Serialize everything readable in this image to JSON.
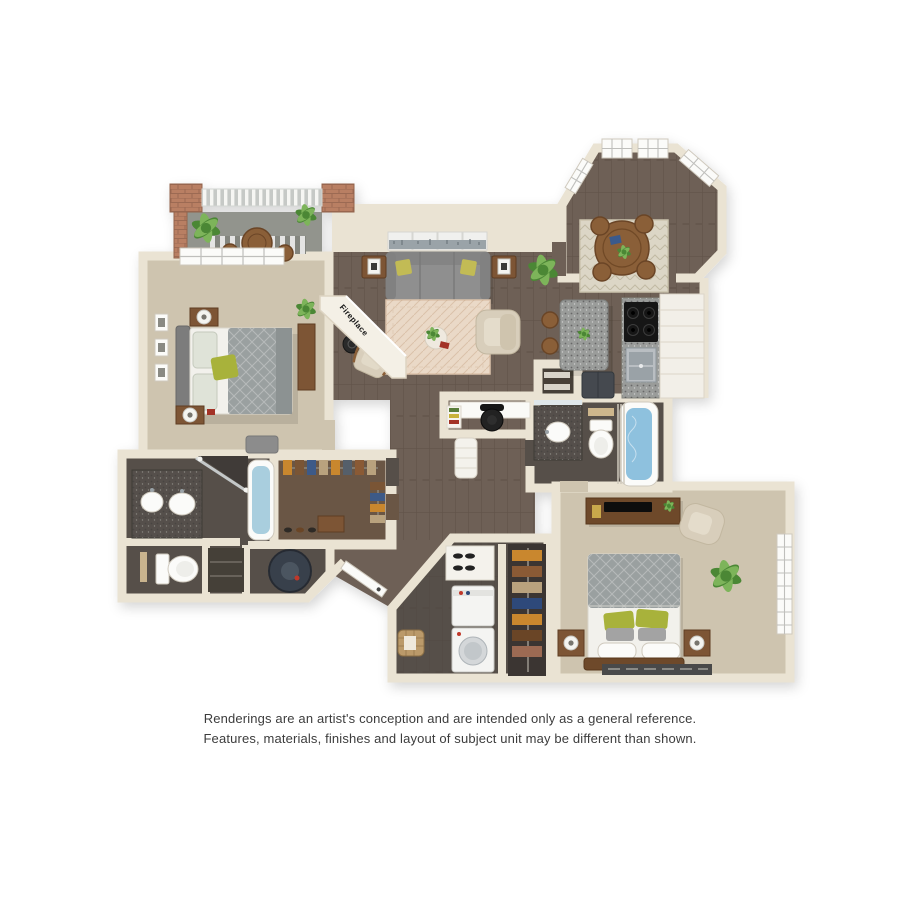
{
  "floorplan": {
    "fireplace_label": "Fireplace",
    "type": "3d-floor-plan-rendering",
    "rooms_depicted": [
      "balcony",
      "bedroom-1",
      "living-room",
      "dining-nook",
      "kitchen",
      "bathroom-2",
      "bedroom-2",
      "master-bathroom",
      "walk-in-closet",
      "laundry-room",
      "entry-hall",
      "desk-nook"
    ]
  },
  "disclaimer": {
    "line1": "Renderings are an artist's conception and are intended only as a general reference.",
    "line2": "Features, materials, finishes and layout of subject unit may be different than shown."
  },
  "colors": {
    "background": "#ffffff",
    "wall": "#eae3d3",
    "wall_stroke": "#d9d0bd",
    "wood_floor": "#6e6156",
    "wood_floor_dark": "#575049",
    "carpet": "#cec4af",
    "balcony_floor": "#92948d",
    "brick": "#b97f63",
    "sofa_gray": "#8f8f8f",
    "bed_gray": "#9aa0a0",
    "linen_white": "#f2f1ec",
    "accent_green": "#a8b23a",
    "wood_furniture": "#7d5434",
    "wood_table": "#8a5e38",
    "granite_light": "#9a9c9a",
    "granite_dark": "#55504b",
    "fixture_white": "#fbfbf9",
    "water_blue": "#8ec1de",
    "rug_cream": "#ead9c7",
    "rug_dining": "#dcd6c6",
    "plant_green": "#4c8736",
    "plant_green_light": "#7db45a",
    "chair_beige": "#d8cebb",
    "text": "#3c3c3c"
  }
}
